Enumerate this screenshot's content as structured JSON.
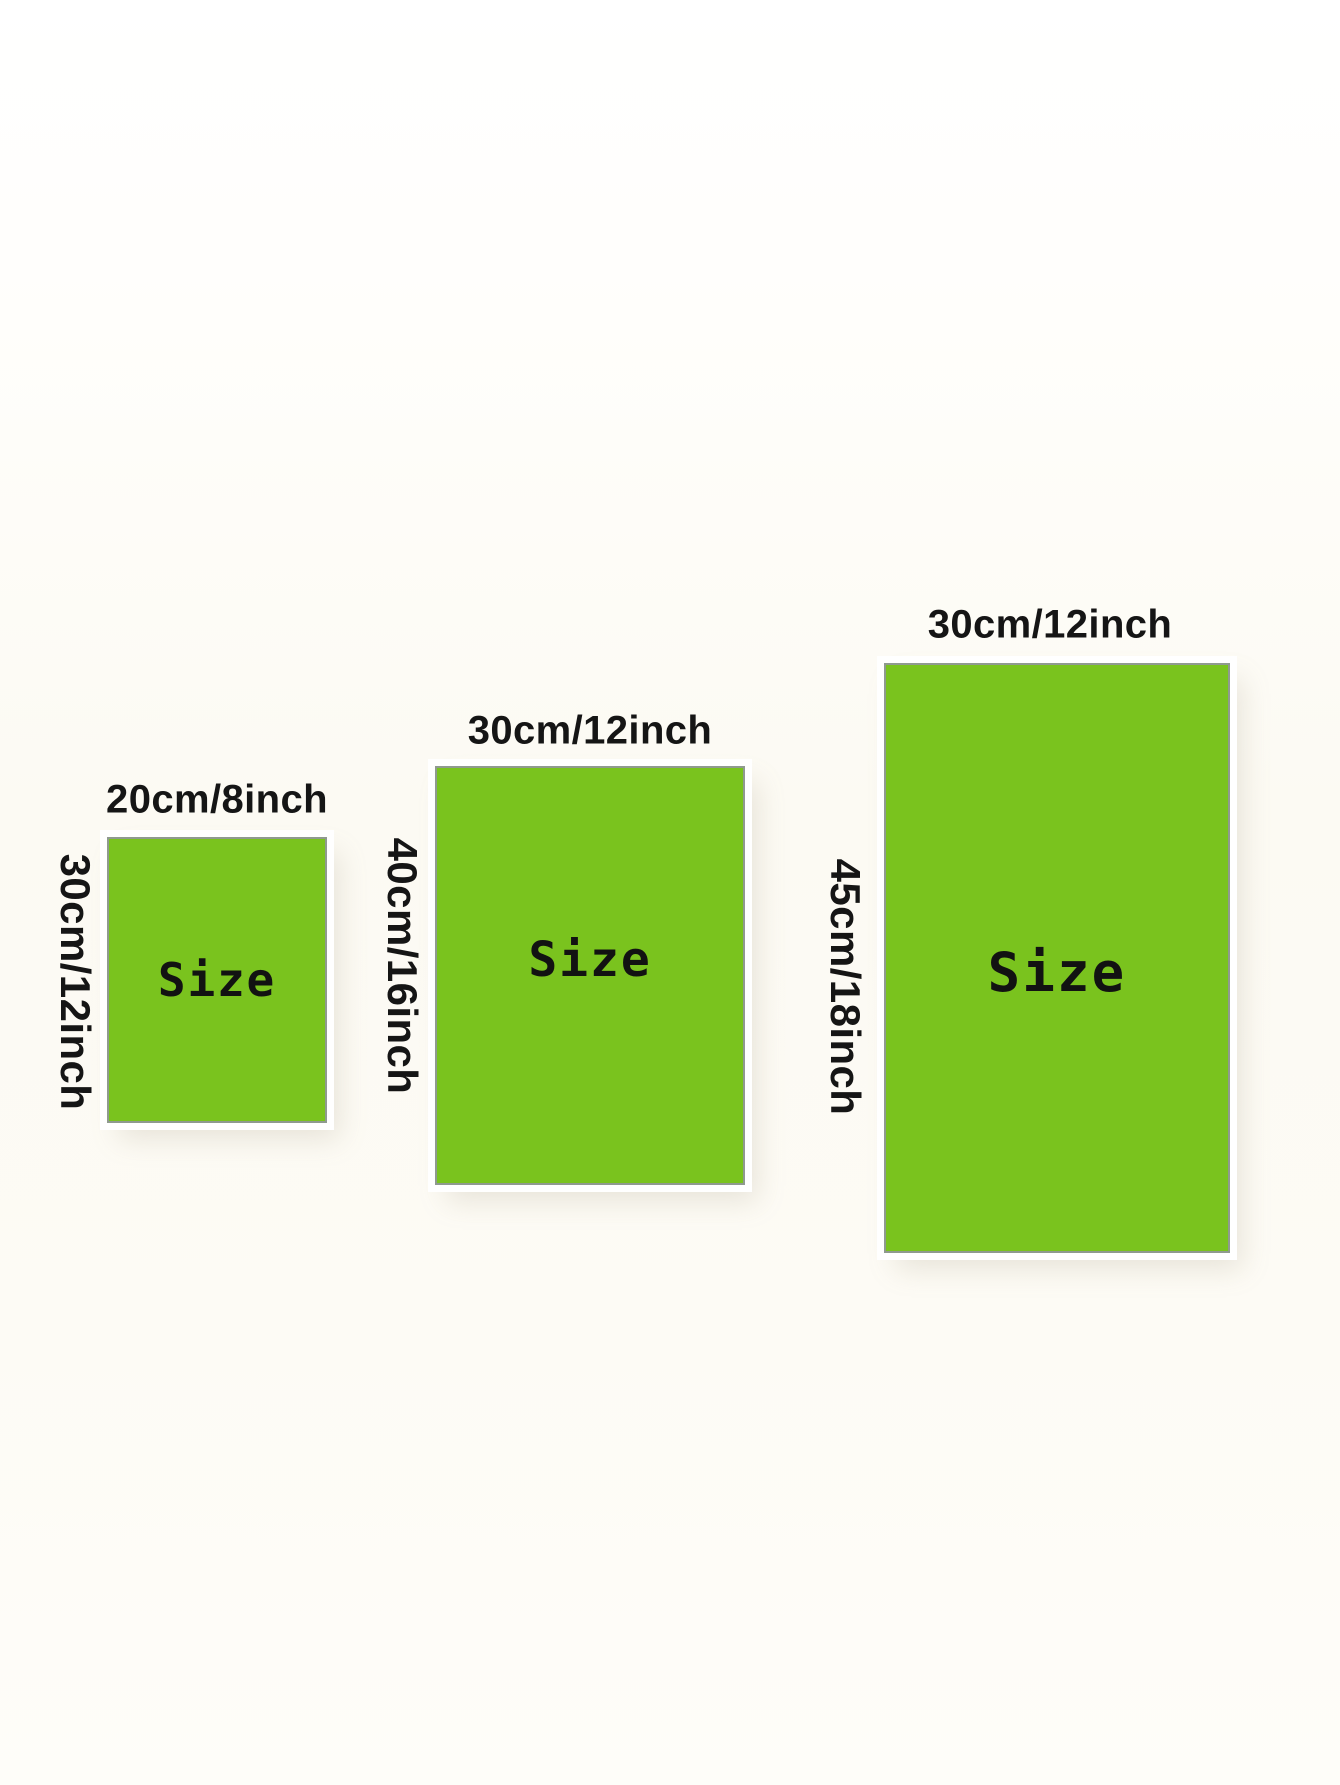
{
  "colors": {
    "rect-fill": "#7ac31e",
    "rect-border": "#8f9a8f",
    "label-color": "#151515"
  },
  "panels": [
    {
      "id": "small",
      "top_label": "20cm/8inch",
      "side_label": "30cm/12inch",
      "center_label": "Size"
    },
    {
      "id": "medium",
      "top_label": "30cm/12inch",
      "side_label": "40cm/16inch",
      "center_label": "Size"
    },
    {
      "id": "large",
      "top_label": "30cm/12inch",
      "side_label": "45cm/18inch",
      "center_label": "Size"
    }
  ]
}
